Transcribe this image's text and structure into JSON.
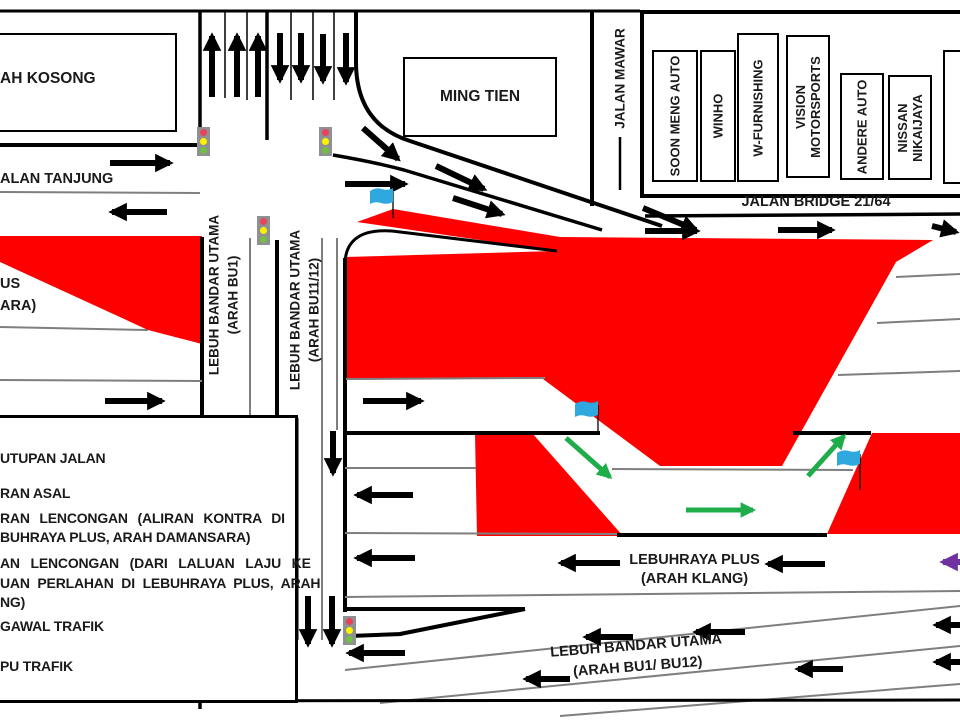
{
  "labels": {
    "tanah_kosong": "AH KOSONG",
    "jalan_tanjung": "ALAN TANJUNG",
    "ming_tien": "MING TIEN",
    "jalan_mawar": "JALAN MAWAR",
    "jalan_bridge": "JALAN BRIDGE 21/64",
    "plus_damansara_line1": "US",
    "plus_damansara_line2": "ARA)",
    "lbu_bu1_line1": "LEBUH BANDAR UTAMA",
    "lbu_bu1_line2": "(ARAH BU1)",
    "lbu_bu1112_line1": "LEBUH BANDAR UTAMA",
    "lbu_bu1112_line2": "(ARAH BU11/12)",
    "plus_klang_line1": "LEBUHRAYA PLUS",
    "plus_klang_line2": "(ARAH KLANG)",
    "lbu_bottom_line1": "LEBUH BANDAR UTAMA",
    "lbu_bottom_line2": "(ARAH BU1/ BU12)"
  },
  "businesses": [
    "SOON MENG AUTO",
    "WINHO",
    "W-FURNISHING",
    "VISION MOTORSPORTS",
    "ANDERE AUTO",
    "NISSAN NIKAIJAYA"
  ],
  "legend": {
    "items": [
      "UTUPAN JALAN",
      "RAN ASAL",
      "RAN LENCONGAN (ALIRAN KONTRA DI",
      "BUHRAYA PLUS, ARAH DAMANSARA)",
      "AN LENCONGAN (DARI LALUAN LAJU KE",
      "UAN PERLAHAN DI LEBUHRAYA PLUS, ARAH",
      "NG)",
      "GAWAL TRAFIK",
      "PU TRAFIK"
    ]
  },
  "icons": {
    "traffic_light": "lampu-trafik-icon",
    "flag": "pengawal-trafik-flag-icon"
  },
  "colors": {
    "road_closure": "#FF0000",
    "original_flow_arrow": "#000000",
    "diversion_contra_arrow": "#1FAC4B",
    "diversion_slowlane_arrow": "#7030A0",
    "flag": "#2FA8DF",
    "traffic_light_body": "#8F9093",
    "traffic_light_red": "#E8435A",
    "traffic_light_yellow": "#FFF200",
    "traffic_light_green": "#72BF44"
  }
}
